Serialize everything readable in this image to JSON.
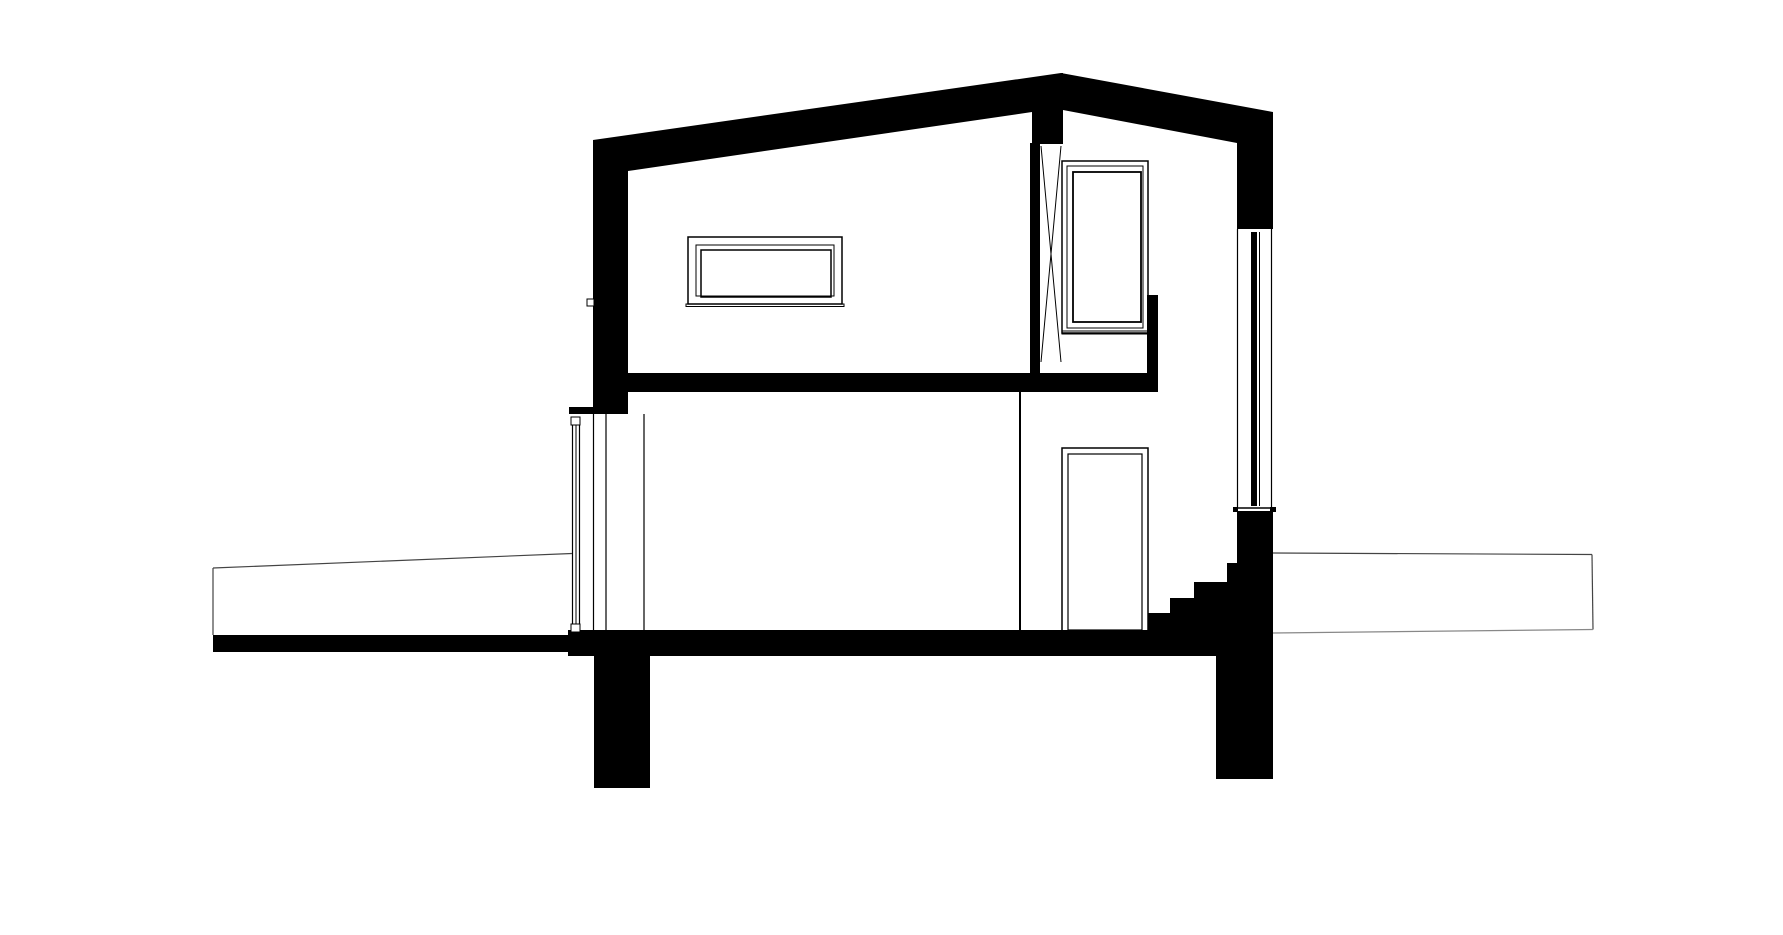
{
  "canvas": {
    "width": 1783,
    "height": 935,
    "background": "#ffffff",
    "ink": "#000000",
    "ground_line_color": "#444444",
    "faint_line_color": "#888888"
  },
  "drawing": {
    "description_name": "house-cross-section",
    "black_polygons": [
      {
        "name": "roof-left-band",
        "points": "593,140 1061,73 1063,73 1063,112 1032,112 628,171 593,171"
      },
      {
        "name": "roof-right-band",
        "points": "1061,73 1273,112 1273,145 1237,143 1063,110"
      },
      {
        "name": "stair-mass",
        "points": "1237,511 1273,511 1273,632 1148,632 1148,613 1170,613 1170,598 1194,598 1194,582 1227,582 1227,563 1237,563"
      }
    ],
    "black_rects": [
      {
        "name": "ridge-post",
        "x": 1032,
        "y": 100,
        "w": 31,
        "h": 44
      },
      {
        "name": "right-eave-wall",
        "x": 1237,
        "y": 112,
        "w": 36,
        "h": 117
      },
      {
        "name": "upper-left-wall",
        "x": 593,
        "y": 140,
        "w": 35,
        "h": 274
      },
      {
        "name": "lower-window-head-ledge",
        "x": 569,
        "y": 407,
        "w": 59,
        "h": 7
      },
      {
        "name": "mid-floor-slab",
        "x": 593,
        "y": 373,
        "w": 565,
        "h": 19
      },
      {
        "name": "window-side-strip",
        "x": 1147,
        "y": 295,
        "w": 11,
        "h": 97
      },
      {
        "name": "ridge-strip-wall",
        "x": 1030,
        "y": 143,
        "w": 10,
        "h": 232
      },
      {
        "name": "glazing-mullion",
        "x": 1251,
        "y": 232,
        "w": 6,
        "h": 274
      },
      {
        "name": "ground-slab-band",
        "x": 213,
        "y": 635,
        "w": 1060,
        "h": 17
      },
      {
        "name": "house-floor-band",
        "x": 568,
        "y": 630,
        "w": 705,
        "h": 26
      },
      {
        "name": "left-foundation-pier",
        "x": 594,
        "y": 656,
        "w": 56,
        "h": 132
      },
      {
        "name": "right-foundation-pier",
        "x": 1216,
        "y": 656,
        "w": 57,
        "h": 123
      },
      {
        "name": "glazing-sill-block-left",
        "x": 1233,
        "y": 507,
        "w": 5,
        "h": 5
      },
      {
        "name": "glazing-sill-block-right",
        "x": 1270,
        "y": 507,
        "w": 6,
        "h": 5
      }
    ],
    "outline_rects": [
      {
        "name": "upper-window-outer-frame",
        "x": 688,
        "y": 237,
        "w": 154,
        "h": 67,
        "sw": 1.5
      },
      {
        "name": "upper-window-mid-frame",
        "x": 696,
        "y": 245,
        "w": 138,
        "h": 51,
        "sw": 1
      },
      {
        "name": "upper-window-inner-frame",
        "x": 701,
        "y": 250,
        "w": 130,
        "h": 47,
        "sw": 1.5
      },
      {
        "name": "upper-window-sill",
        "x": 686,
        "y": 304,
        "w": 158,
        "h": 2.5,
        "sw": 1
      },
      {
        "name": "tall-window-outer-frame",
        "x": 1062,
        "y": 161,
        "w": 86,
        "h": 172,
        "sw": 1.5
      },
      {
        "name": "tall-window-mid-frame",
        "x": 1067,
        "y": 166,
        "w": 76,
        "h": 162,
        "sw": 1
      },
      {
        "name": "tall-window-inner-frame",
        "x": 1073,
        "y": 172,
        "w": 68,
        "h": 150,
        "sw": 1.8
      },
      {
        "name": "tall-window-sill",
        "x": 1062,
        "y": 331,
        "w": 94,
        "h": 3,
        "sw": 1
      },
      {
        "name": "door-frame",
        "x": 1062,
        "y": 448,
        "w": 86,
        "h": 184,
        "sw": 1.5
      },
      {
        "name": "door-leaf",
        "x": 1068,
        "y": 454,
        "w": 74,
        "h": 176,
        "sw": 1.2
      },
      {
        "name": "wall-marker-square",
        "x": 587,
        "y": 299,
        "w": 7,
        "h": 7,
        "sw": 1,
        "fill": "#ffffff"
      },
      {
        "name": "lower-window-frame-top",
        "x": 571,
        "y": 417,
        "w": 9,
        "h": 8,
        "sw": 1,
        "fill": "#ffffff"
      },
      {
        "name": "lower-window-frame-bottom",
        "x": 571,
        "y": 624,
        "w": 9,
        "h": 8,
        "sw": 1,
        "fill": "#ffffff"
      }
    ],
    "lines": [
      {
        "name": "x-brace-diagonal-a",
        "x1": 1041,
        "y1": 146,
        "x2": 1061,
        "y2": 362,
        "sw": 1
      },
      {
        "name": "x-brace-diagonal-b",
        "x1": 1061,
        "y1": 146,
        "x2": 1041,
        "y2": 362,
        "sw": 1
      },
      {
        "name": "right-glazing-inner-line",
        "x1": 1237.5,
        "y1": 229,
        "x2": 1237.5,
        "y2": 508,
        "sw": 1.2
      },
      {
        "name": "right-glazing-outer-line",
        "x1": 1271.5,
        "y1": 229,
        "x2": 1271.5,
        "y2": 508,
        "sw": 1.2
      },
      {
        "name": "right-glazing-mid-line",
        "x1": 1259.5,
        "y1": 232,
        "x2": 1259.5,
        "y2": 506,
        "sw": 1
      },
      {
        "name": "right-glazing-sill-line",
        "x1": 1233,
        "y1": 508,
        "x2": 1276,
        "y2": 508,
        "sw": 1.5
      },
      {
        "name": "lower-window-outer-line",
        "x1": 572.5,
        "y1": 420,
        "x2": 572.5,
        "y2": 629,
        "sw": 1.2
      },
      {
        "name": "lower-window-inner-line",
        "x1": 579.5,
        "y1": 420,
        "x2": 579.5,
        "y2": 629,
        "sw": 1.2
      },
      {
        "name": "lower-window-glass-line",
        "x1": 576,
        "y1": 425,
        "x2": 576,
        "y2": 624,
        "sw": 1
      },
      {
        "name": "lower-wall-line-a",
        "x1": 593.5,
        "y1": 414,
        "x2": 593.5,
        "y2": 630,
        "sw": 1.2
      },
      {
        "name": "lower-wall-line-b",
        "x1": 606,
        "y1": 414,
        "x2": 606,
        "y2": 630,
        "sw": 1.2
      },
      {
        "name": "lower-wall-line-c",
        "x1": 644,
        "y1": 414,
        "x2": 644,
        "y2": 630,
        "sw": 1.2
      },
      {
        "name": "interior-partition-line",
        "x1": 1020,
        "y1": 392,
        "x2": 1020,
        "y2": 630,
        "sw": 2
      },
      {
        "name": "left-terrace-surface-line",
        "x1": 213,
        "y1": 568,
        "x2": 572,
        "y2": 553.5,
        "sw": 1.2,
        "color": "#444444"
      },
      {
        "name": "left-terrace-edge-line",
        "x1": 213,
        "y1": 568,
        "x2": 213,
        "y2": 635,
        "sw": 1.2,
        "color": "#444444"
      },
      {
        "name": "right-terrace-surface-line",
        "x1": 1273,
        "y1": 553,
        "x2": 1592,
        "y2": 554.5,
        "sw": 1.2,
        "color": "#444444"
      },
      {
        "name": "right-terrace-edge-line",
        "x1": 1592,
        "y1": 554.5,
        "x2": 1593,
        "y2": 629.5,
        "sw": 1.2,
        "color": "#444444"
      },
      {
        "name": "right-terrace-bottom-line",
        "x1": 1273,
        "y1": 633,
        "x2": 1593,
        "y2": 629.5,
        "sw": 1.2,
        "color": "#888888"
      }
    ]
  }
}
